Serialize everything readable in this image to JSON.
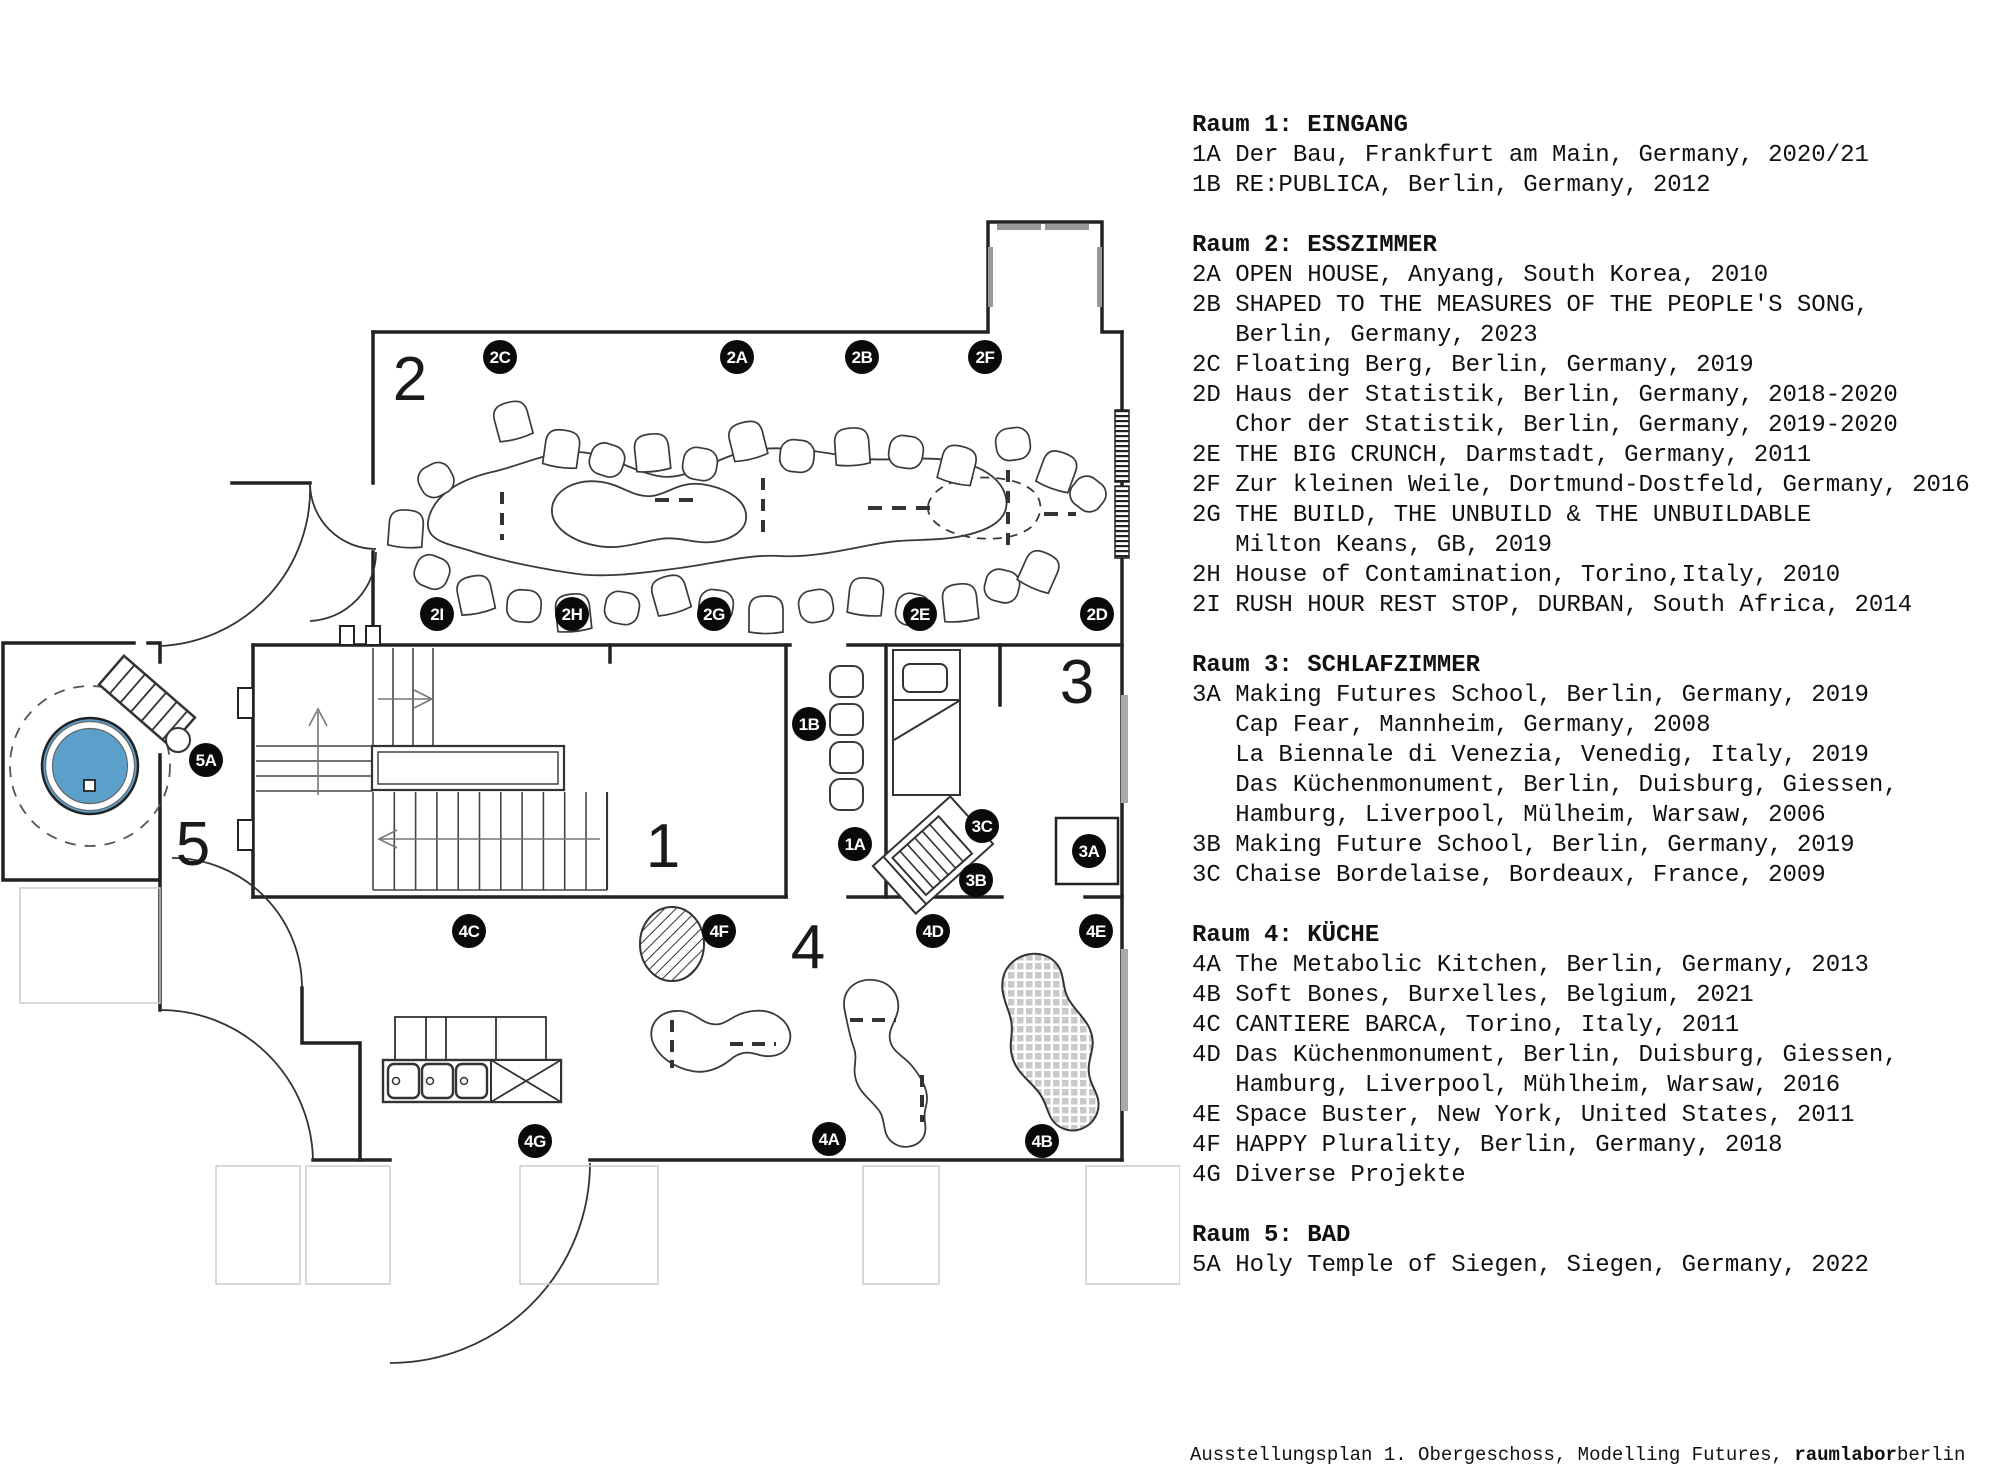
{
  "legend": {
    "sections": [
      {
        "header": "Raum 1: EINGANG",
        "items": [
          "1A Der Bau, Frankfurt am Main, Germany, 2020/21",
          "1B RE:PUBLICA, Berlin, Germany, 2012"
        ]
      },
      {
        "header": "Raum 2: ESSZIMMER",
        "items": [
          "2A OPEN HOUSE, Anyang, South Korea, 2010",
          "2B SHAPED TO THE MEASURES OF THE PEOPLE'S SONG,",
          "   Berlin, Germany, 2023",
          "2C Floating Berg, Berlin, Germany, 2019",
          "2D Haus der Statistik, Berlin, Germany, 2018-2020",
          "   Chor der Statistik, Berlin, Germany, 2019-2020",
          "2E THE BIG CRUNCH, Darmstadt, Germany, 2011",
          "2F Zur kleinen Weile, Dortmund-Dostfeld, Germany, 2016",
          "2G THE BUILD, THE UNBUILD & THE UNBUILDABLE",
          "   Milton Keans, GB, 2019",
          "2H House of Contamination, Torino,Italy, 2010",
          "2I RUSH HOUR REST STOP, DURBAN, South Africa, 2014"
        ]
      },
      {
        "header": "Raum 3: SCHLAFZIMMER",
        "items": [
          "3A Making Futures School, Berlin, Germany, 2019",
          "   Cap Fear, Mannheim, Germany, 2008",
          "   La Biennale di Venezia, Venedig, Italy, 2019",
          "   Das Küchenmonument, Berlin, Duisburg, Giessen,",
          "   Hamburg, Liverpool, Mülheim, Warsaw, 2006",
          "3B Making Future School, Berlin, Germany, 2019",
          "3C Chaise Bordelaise, Bordeaux, France, 2009"
        ]
      },
      {
        "header": "Raum 4: KÜCHE",
        "items": [
          "4A The Metabolic Kitchen, Berlin, Germany, 2013",
          "4B Soft Bones, Burxelles, Belgium, 2021",
          "4C CANTIERE BARCA, Torino, Italy, 2011",
          "4D Das Küchenmonument, Berlin, Duisburg, Giessen,",
          "   Hamburg, Liverpool, Mühlheim, Warsaw, 2016",
          "4E Space Buster, New York, United States, 2011",
          "4F HAPPY Plurality, Berlin, Germany, 2018",
          "4G Diverse Projekte"
        ]
      },
      {
        "header": "Raum 5: BAD",
        "items": [
          "5A Holy Temple of Siegen, Siegen, Germany, 2022"
        ]
      }
    ]
  },
  "caption": {
    "prefix": "Ausstellungsplan 1. Obergeschoss, Modelling Futures, ",
    "brand_bold": "raumlabor",
    "brand_rest": "berlin"
  },
  "plan": {
    "colors": {
      "pool_blue": "#5B9FCB",
      "marker_bg": "#0a0a0a",
      "wall": "#222222"
    },
    "room_labels": [
      {
        "label": "2",
        "x": 410,
        "y": 400
      },
      {
        "label": "1",
        "x": 663,
        "y": 867
      },
      {
        "label": "3",
        "x": 1077,
        "y": 703
      },
      {
        "label": "4",
        "x": 808,
        "y": 968
      },
      {
        "label": "5",
        "x": 193,
        "y": 865
      }
    ],
    "markers": [
      {
        "label": "2C",
        "x": 500,
        "y": 357
      },
      {
        "label": "2A",
        "x": 737,
        "y": 357
      },
      {
        "label": "2B",
        "x": 862,
        "y": 357
      },
      {
        "label": "2F",
        "x": 985,
        "y": 357
      },
      {
        "label": "2I",
        "x": 437,
        "y": 614
      },
      {
        "label": "2H",
        "x": 572,
        "y": 614
      },
      {
        "label": "2G",
        "x": 714,
        "y": 614
      },
      {
        "label": "2E",
        "x": 920,
        "y": 614
      },
      {
        "label": "2D",
        "x": 1097,
        "y": 614
      },
      {
        "label": "1B",
        "x": 809,
        "y": 724
      },
      {
        "label": "1A",
        "x": 855,
        "y": 844
      },
      {
        "label": "3C",
        "x": 982,
        "y": 826
      },
      {
        "label": "3B",
        "x": 976,
        "y": 880
      },
      {
        "label": "3A",
        "x": 1089,
        "y": 851
      },
      {
        "label": "5A",
        "x": 206,
        "y": 760
      },
      {
        "label": "4C",
        "x": 469,
        "y": 931
      },
      {
        "label": "4F",
        "x": 719,
        "y": 931
      },
      {
        "label": "4D",
        "x": 933,
        "y": 931
      },
      {
        "label": "4E",
        "x": 1096,
        "y": 931
      },
      {
        "label": "4G",
        "x": 535,
        "y": 1141
      },
      {
        "label": "4A",
        "x": 829,
        "y": 1139
      },
      {
        "label": "4B",
        "x": 1042,
        "y": 1141
      }
    ]
  }
}
